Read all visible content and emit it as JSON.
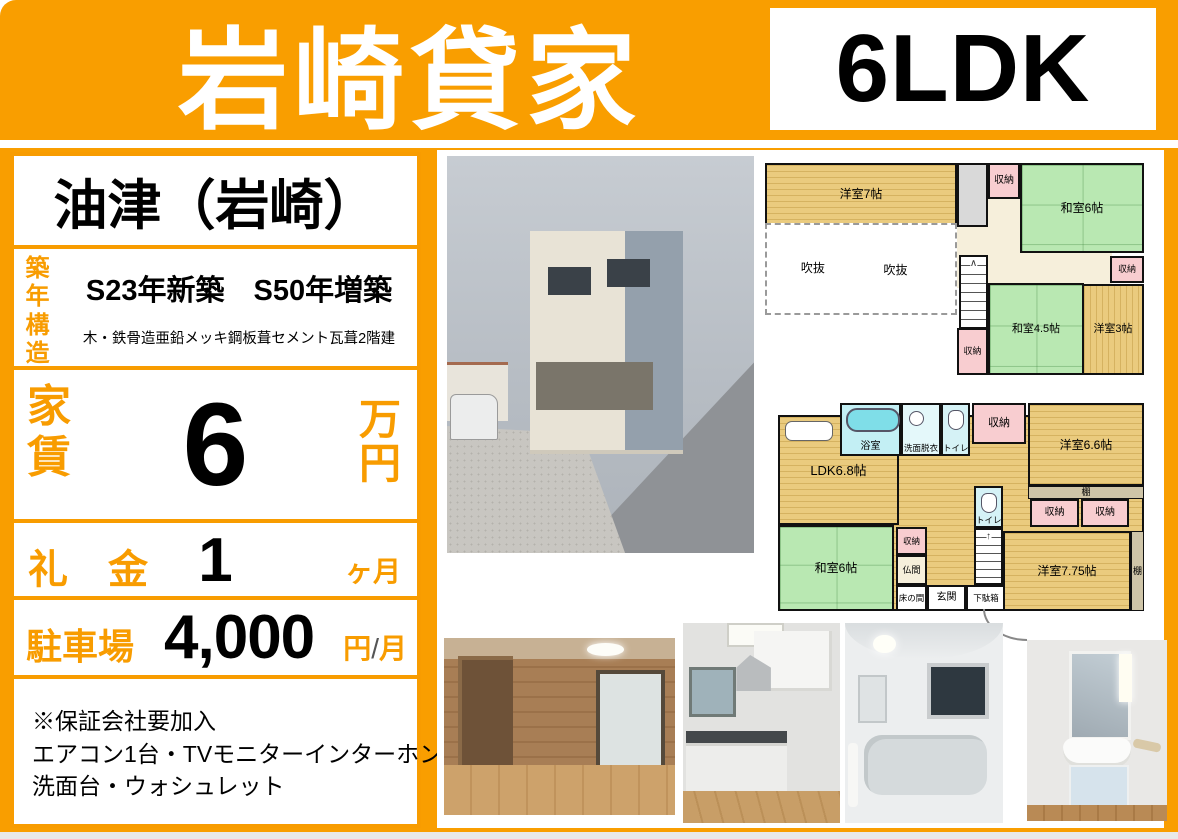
{
  "colors": {
    "accent_orange": "#F99E00",
    "border_orange": "#F89C00",
    "text_black": "#000000",
    "plan_tan": "#EACB7E",
    "plan_green": "#B9E8B2",
    "plan_pink": "#F8CDD0",
    "plan_cyan": "#C3EFF4"
  },
  "header": {
    "title": "岩崎貸家",
    "badge": "6LDK"
  },
  "info": {
    "location": "油津（岩崎）",
    "built": {
      "label": "築年構造",
      "value": "S23年新築　S50年増築",
      "note": "木・鉄骨造亜鉛メッキ鋼板葺セメント瓦葺2階建"
    },
    "rent": {
      "label": "家賃",
      "value": "6",
      "unit": "万円"
    },
    "key_money": {
      "label": "礼　金",
      "value": "1",
      "unit": "ヶ月"
    },
    "parking": {
      "label": "駐車場",
      "value": "4,000",
      "unit_yen": "円",
      "unit_slash": "/",
      "unit_month": "月"
    },
    "notes": [
      "※保証会社要加入",
      "エアコン1台・TVモニターインターホン",
      "洗面台・ウォシュレット"
    ]
  },
  "plan2f": {
    "room_yoshitsu7": "洋室7帖",
    "void1": "吹抜",
    "void2": "吹抜",
    "closet_top": "収納",
    "room_washitsu6": "和室6帖",
    "closet_right": "収納",
    "room_washitsu45": "和室4.5帖",
    "room_yoshitsu3": "洋室3帖",
    "closet_bottom": "収納"
  },
  "plan1f": {
    "bath": "浴室",
    "senmen": "洗面脱衣",
    "toilet_top": "トイレ",
    "closet_top": "収納",
    "room_yoshitsu66": "洋室6.6帖",
    "ldk": "LDK6.8帖",
    "toilet_mid": "トイレ",
    "shelf_top": "棚",
    "closet_a": "収納",
    "closet_b": "収納",
    "room_washitsu6": "和室6帖",
    "closet_small": "収納",
    "butsuma": "仏間",
    "tokonoma": "床の間",
    "genkan": "玄関",
    "getabako": "下駄箱",
    "room_yoshitsu775": "洋室7.75帖",
    "shelf_right": "棚"
  }
}
